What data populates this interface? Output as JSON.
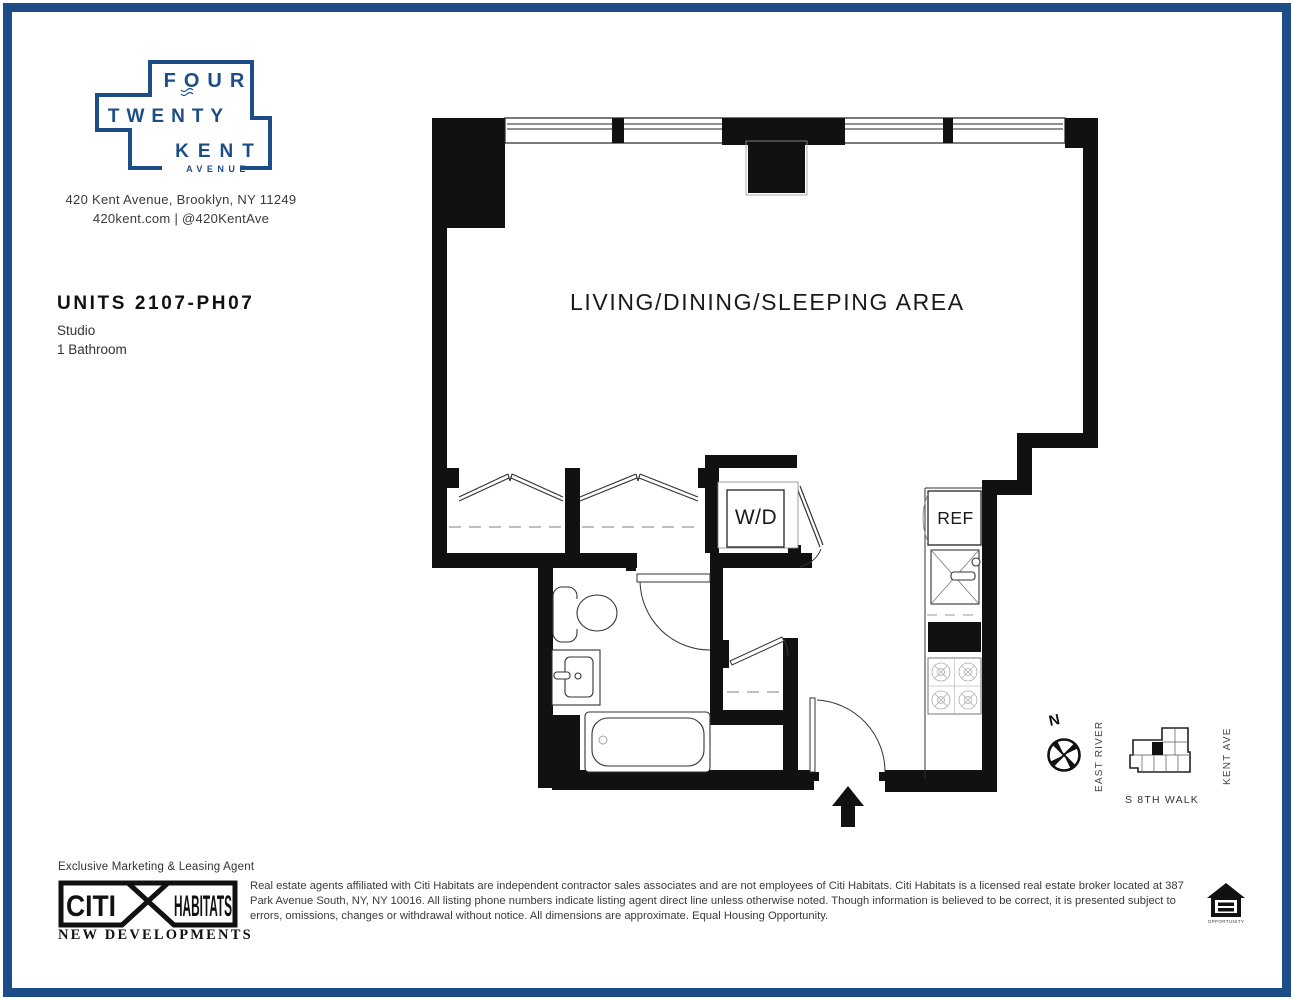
{
  "colors": {
    "brand_blue": "#1d4d86",
    "wall_black": "#111111"
  },
  "brand": {
    "logo_line1": "FOUR",
    "logo_line2": "TWENTY",
    "logo_line3": "KENT",
    "logo_line4": "AVENUE",
    "address_line1": "420 Kent Avenue, Brooklyn, NY 11249",
    "address_line2": "420kent.com | @420KentAve"
  },
  "unit": {
    "title": "UNITS 2107-PH07",
    "type": "Studio",
    "bathrooms": "1 Bathroom"
  },
  "floorplan": {
    "living_label": "LIVING/DINING/SLEEPING AREA",
    "washer_dryer_label": "W/D",
    "refrigerator_label": "REF"
  },
  "map": {
    "north_label": "N",
    "east_river_label": "EAST RIVER",
    "kent_ave_label": "KENT AVE",
    "s8th_walk_label": "S 8TH WALK"
  },
  "footer": {
    "agent_line": "Exclusive Marketing & Leasing Agent",
    "logo_citi": "CITI",
    "logo_habitats": "HABITATS",
    "logo_sub": "NEW DEVELOPMENTS",
    "disclaimer": "Real estate agents affiliated with Citi Habitats are independent contractor sales associates and are not employees of Citi Habitats. Citi Habitats is a licensed real estate broker located at 387 Park Avenue South, NY, NY 10016. All listing phone numbers indicate listing agent direct line unless otherwise noted. Though information is believed to be correct, it is presented subject to errors, omissions, changes or withdrawal without notice. All dimensions are approximate. Equal Housing Opportunity.",
    "eho_label": "OPPORTUNITY"
  }
}
